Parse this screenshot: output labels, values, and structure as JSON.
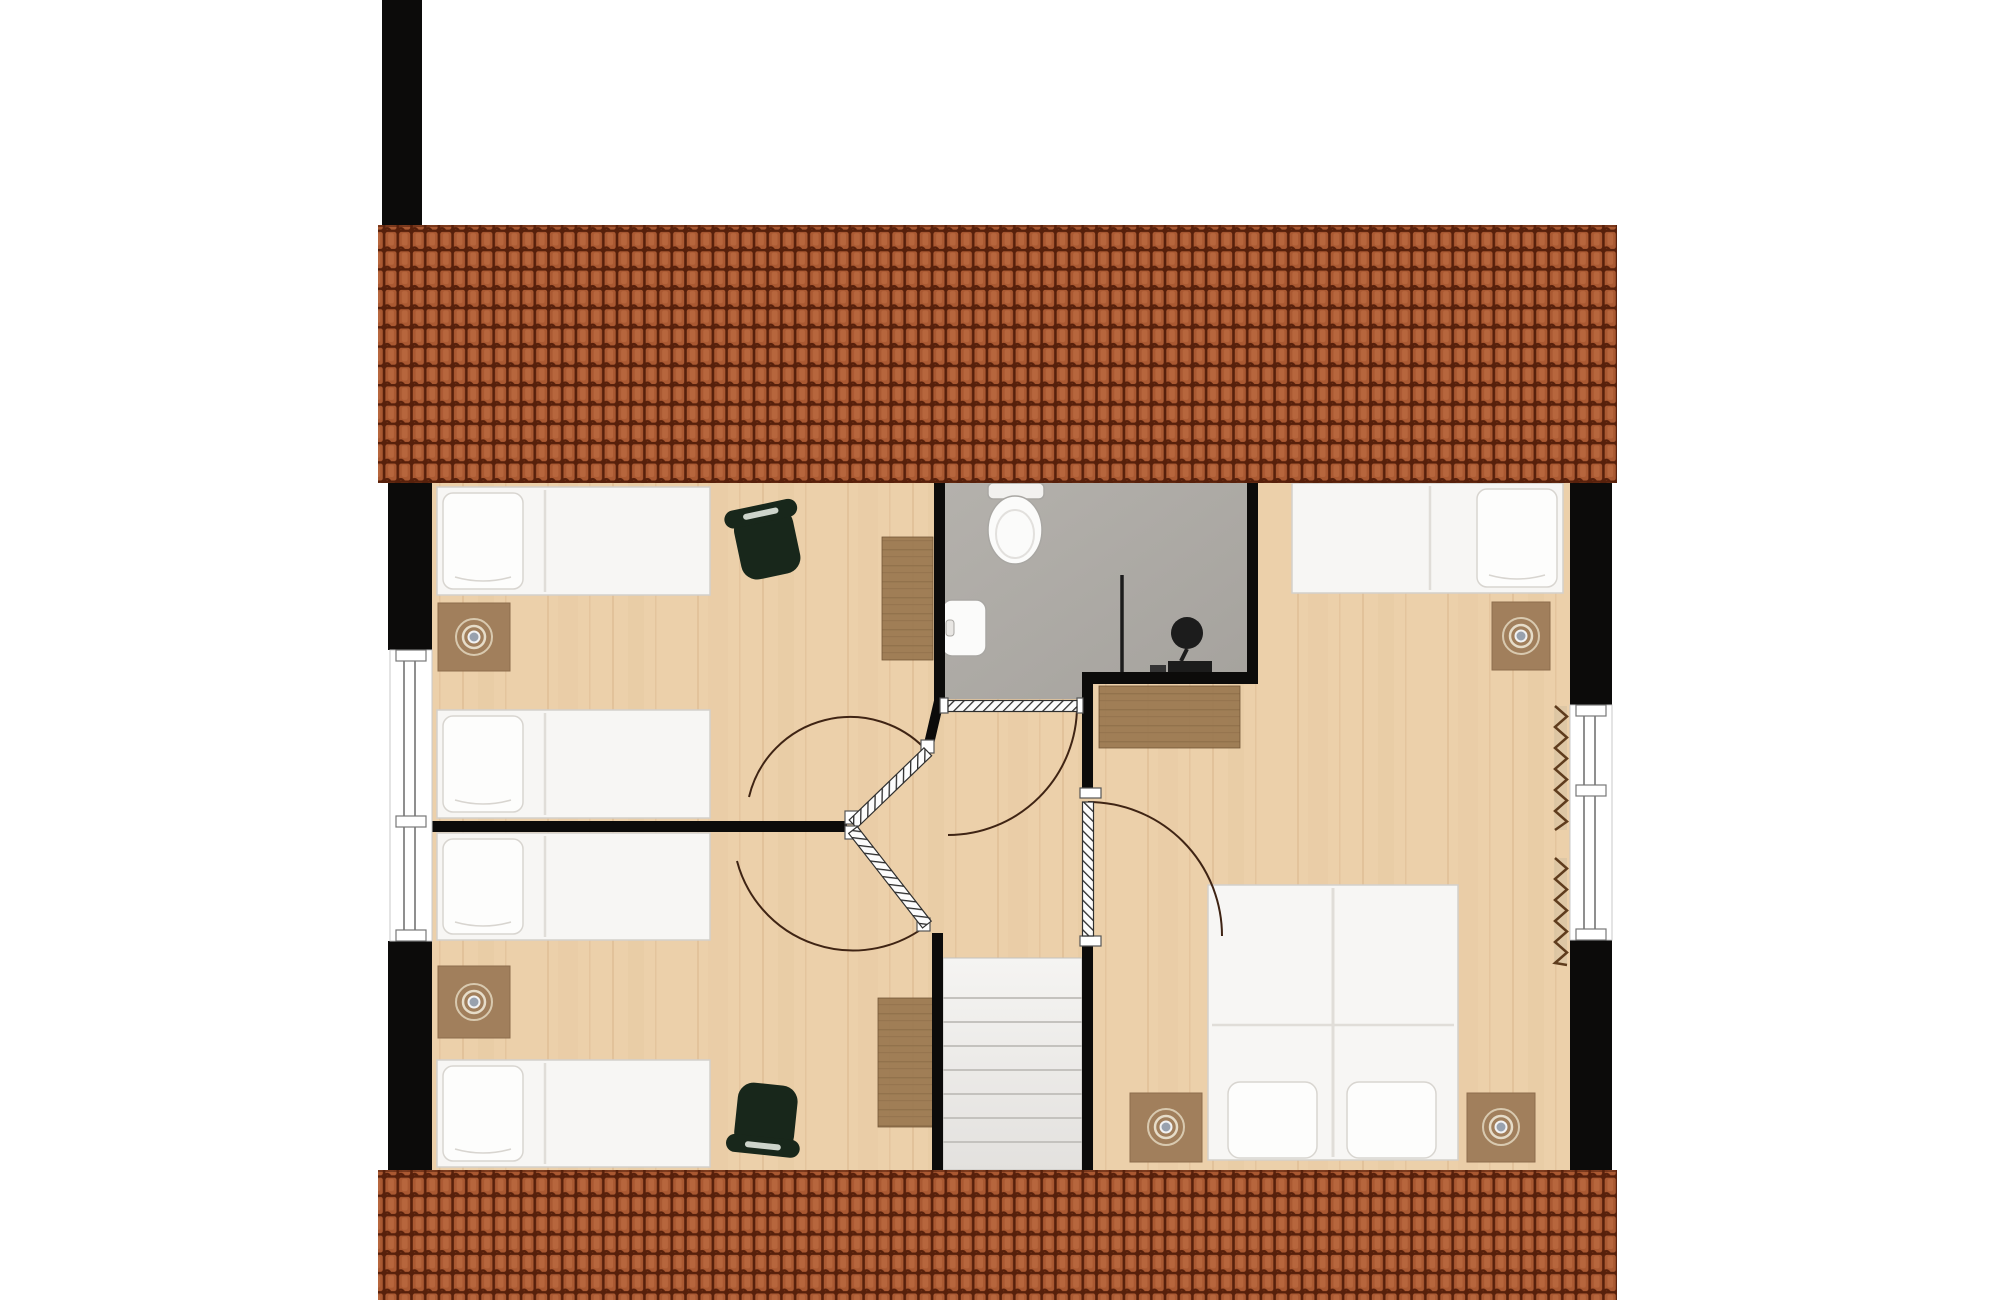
{
  "app": {
    "kind": "architectural-floor-plan",
    "storey": "attic",
    "visible_text": []
  },
  "canvas": {
    "w": 2000,
    "h": 1300,
    "bg": "#ffffff"
  },
  "palette": {
    "wall": "#0c0b0a",
    "roof_tile": "#aa5932",
    "roof_tile_light": "#b7663d",
    "roof_seam": "#57200b",
    "wood_floor": "#ecd0aa",
    "wood_grain": "#c89d6e",
    "bath_floor_1": "#b4b1ac",
    "bath_floor_2": "#a5a29d",
    "furn_white": "#f7f6f4",
    "furn_white_stroke": "#d3d0cb",
    "pillow": "#fdfdfc",
    "pillow_stroke": "#d8d5d0",
    "seam": "#e0ddd8",
    "rug": "#a17f5c",
    "rug_stroke": "#8d6c4c",
    "wood_furniture": "#9d7b53",
    "wood_furniture_grain": "#6f5233",
    "chair_green": "#18271b",
    "chair_slit": "#cdd4cb",
    "stair_top": "#f5f4f2",
    "stair_bottom": "#e3e1de",
    "stair_line": "#c4c2be",
    "door_leaf": "#fcfcfc",
    "door_hatch": "#2b2b2b",
    "door_arc": "#3f2414",
    "window_stroke": "#8f8f8f",
    "radiator_line": "#5f3c1d",
    "radiator_bg": "#d9c4a3",
    "fixture_stroke": "#a9a7a3",
    "fixture_dark": "#1c1c1c",
    "lamp_ring": "#d8c9af",
    "lamp_ring2": "#e6dcc8",
    "lamp_dot": "#98a1ae"
  },
  "roof": {
    "tile_w": 13.7,
    "tile_h": 19.3,
    "bands": [
      {
        "name": "roof-top",
        "x": 378,
        "y": 225,
        "w": 1239,
        "h": 258
      },
      {
        "name": "roof-bottom",
        "x": 378,
        "y": 1170,
        "w": 1239,
        "h": 130
      }
    ]
  },
  "chimney": {
    "name": "chimney",
    "x": 382,
    "y": 0,
    "w": 40,
    "h": 225
  },
  "floors": {
    "wood": {
      "name": "wood-floor",
      "x": 432,
      "y": 483,
      "w": 1138,
      "h": 687
    },
    "bathroom_points": "945,483 1247,483 1247,672 1093,672 1093,699 945,699"
  },
  "rooms": [
    {
      "name": "room-bedroom-left-top",
      "x": 432,
      "y": 483,
      "w": 502,
      "h": 338
    },
    {
      "name": "room-bedroom-left-bottom",
      "x": 432,
      "y": 832,
      "w": 500,
      "h": 338
    },
    {
      "name": "room-bathroom",
      "x": 945,
      "y": 483,
      "w": 302,
      "h": 216
    },
    {
      "name": "room-hallway",
      "x": 847,
      "y": 660,
      "w": 235,
      "h": 298
    },
    {
      "name": "room-bedroom-right",
      "x": 1093,
      "y": 483,
      "w": 477,
      "h": 687
    },
    {
      "name": "room-staircase",
      "x": 943,
      "y": 958,
      "w": 139,
      "h": 212
    }
  ],
  "walls": [
    {
      "name": "wall-left-upper",
      "x": 388,
      "y": 483,
      "w": 44,
      "h": 167
    },
    {
      "name": "wall-left-lower",
      "x": 388,
      "y": 941,
      "w": 44,
      "h": 229
    },
    {
      "name": "wall-divider-left-rooms",
      "x": 432,
      "y": 821,
      "w": 415,
      "h": 11
    },
    {
      "name": "wall-right-upper",
      "x": 1570,
      "y": 483,
      "w": 42,
      "h": 222
    },
    {
      "name": "wall-right-lower",
      "x": 1570,
      "y": 940,
      "w": 42,
      "h": 230
    },
    {
      "name": "wall-bathroom-left",
      "x": 934,
      "y": 483,
      "w": 11,
      "h": 216
    },
    {
      "name": "wall-bathroom-doorstub-left",
      "x": 934,
      "y": 699,
      "w": 14,
      "h": 13
    },
    {
      "name": "wall-bathroom-doorstub-right",
      "x": 1077,
      "y": 699,
      "w": 5,
      "h": 13
    },
    {
      "name": "wall-bathroom-bottom-right",
      "x": 1093,
      "y": 672,
      "w": 165,
      "h": 12
    },
    {
      "name": "wall-bathroom-right",
      "x": 1247,
      "y": 483,
      "w": 11,
      "h": 201
    },
    {
      "name": "wall-bedroom-right-upper",
      "x": 1082,
      "y": 672,
      "w": 11,
      "h": 118
    },
    {
      "name": "wall-bedroom-right-lower",
      "x": 1082,
      "y": 946,
      "w": 11,
      "h": 224
    },
    {
      "name": "wall-staircase-left",
      "x": 932,
      "y": 933,
      "w": 11,
      "h": 237
    }
  ],
  "wall_segments": [
    {
      "name": "wall-diagonal-bathroom-corner",
      "x1": 928,
      "y1": 748,
      "x2": 939,
      "y2": 701,
      "w": 10
    }
  ],
  "windows": [
    {
      "name": "window-left",
      "x": 390,
      "y": 650,
      "w": 42,
      "h": 291,
      "lines": [
        404,
        415
      ],
      "dividers": [
        650,
        816,
        930
      ],
      "div_h": 11
    },
    {
      "name": "window-right",
      "x": 1570,
      "y": 705,
      "w": 42,
      "h": 235,
      "lines": [
        1584,
        1595
      ],
      "dividers": [
        705,
        785,
        929
      ],
      "div_h": 11
    }
  ],
  "doors": [
    {
      "name": "door-bathroom",
      "hx": 948,
      "hy": 706,
      "len": 129,
      "thick": 11,
      "angle": 0,
      "jambs": [
        [
          940,
          698,
          8,
          15
        ],
        [
          1077,
          698,
          6,
          15
        ]
      ],
      "arc": "M 1077,706 A 129 129 0 0 1 948,835"
    },
    {
      "name": "door-bedroom-left-top",
      "hx": 853,
      "hy": 824,
      "len": 104,
      "thick": 11,
      "angle": -44,
      "jambs": [
        [
          845,
          811,
          13,
          13
        ],
        [
          921,
          740,
          13,
          13
        ]
      ],
      "arc": "M 928,752 A 104 104 0 0 0 749,797"
    },
    {
      "name": "door-bedroom-left-bottom",
      "hx": 853,
      "hy": 830,
      "len": 120,
      "thick": 11,
      "angle": 52,
      "jambs": [
        [
          845,
          826,
          13,
          13
        ],
        [
          917,
          918,
          13,
          13
        ]
      ],
      "arc": "M 927,925 A 120 120 0 0 1 737,861"
    },
    {
      "name": "door-bedroom-right",
      "hx": 1088,
      "hy": 936,
      "len": 134,
      "thick": 11,
      "angle": -90,
      "jambs": [
        [
          1080,
          788,
          21,
          10
        ],
        [
          1080,
          936,
          21,
          10
        ]
      ],
      "arc": "M 1088,802 A 134 134 0 0 1 1222,936"
    }
  ],
  "stairs": {
    "name": "staircase",
    "x": 943,
    "y": 958,
    "w": 139,
    "h": 212,
    "tread_lines": [
      998,
      1022,
      1046,
      1070,
      1094,
      1118,
      1142
    ]
  },
  "furniture": {
    "single_beds": [
      {
        "name": "single-bed-1",
        "x": 437,
        "y": 487,
        "w": 273,
        "h": 108,
        "pillow_side": "left",
        "seam_x": 545
      },
      {
        "name": "single-bed-2",
        "x": 437,
        "y": 710,
        "w": 273,
        "h": 108,
        "pillow_side": "left",
        "seam_x": 545
      },
      {
        "name": "single-bed-3",
        "x": 437,
        "y": 833,
        "w": 273,
        "h": 107,
        "pillow_side": "left",
        "seam_x": 545
      },
      {
        "name": "single-bed-4",
        "x": 437,
        "y": 1060,
        "w": 273,
        "h": 107,
        "pillow_side": "left",
        "seam_x": 545
      },
      {
        "name": "single-bed-5",
        "x": 1292,
        "y": 483,
        "w": 271,
        "h": 110,
        "pillow_side": "right",
        "seam_x": 1430
      }
    ],
    "double_bed": {
      "name": "double-bed",
      "x": 1208,
      "y": 885,
      "w": 250,
      "h": 275,
      "seam_x": 1333,
      "seam_y": 1025,
      "pillows": [
        [
          1228,
          1082,
          89,
          76
        ],
        [
          1347,
          1082,
          89,
          76
        ]
      ]
    },
    "rug_tables": [
      {
        "name": "nightstand-rug-1",
        "x": 438,
        "y": 603,
        "w": 72,
        "h": 68,
        "lamp": [
          474,
          637
        ]
      },
      {
        "name": "nightstand-rug-2",
        "x": 438,
        "y": 966,
        "w": 72,
        "h": 72,
        "lamp": [
          474,
          1002
        ]
      },
      {
        "name": "nightstand-rug-3",
        "x": 1492,
        "y": 602,
        "w": 58,
        "h": 68,
        "lamp": [
          1521,
          636
        ]
      },
      {
        "name": "nightstand-rug-4",
        "x": 1130,
        "y": 1093,
        "w": 72,
        "h": 69,
        "lamp": [
          1166,
          1127
        ]
      },
      {
        "name": "nightstand-rug-5",
        "x": 1467,
        "y": 1093,
        "w": 68,
        "h": 69,
        "lamp": [
          1501,
          1127
        ]
      }
    ],
    "desks": [
      {
        "name": "desk-bedroom-left-top",
        "x": 882,
        "y": 537,
        "w": 51,
        "h": 123
      },
      {
        "name": "desk-bedroom-left-bottom",
        "x": 878,
        "y": 998,
        "w": 55,
        "h": 129
      }
    ],
    "dresser": {
      "name": "dresser",
      "x": 1099,
      "y": 686,
      "w": 141,
      "h": 62
    },
    "chairs": [
      {
        "name": "chair-bedroom-left-top",
        "cx": 767,
        "cy": 543,
        "rot": -12,
        "back": "top"
      },
      {
        "name": "chair-bedroom-left-bottom",
        "cx": 766,
        "cy": 1116,
        "rot": 6,
        "back": "bottom"
      }
    ],
    "radiators": [
      {
        "name": "radiator-right-upper",
        "x": 1553,
        "y1": 706,
        "y2": 830
      },
      {
        "name": "radiator-right-lower",
        "x": 1553,
        "y1": 858,
        "y2": 965
      }
    ],
    "bathroom_fixtures": {
      "toilet": {
        "name": "toilet",
        "tank": [
          988,
          483,
          56,
          16
        ],
        "bowl_cx": 1015,
        "bowl_cy": 530,
        "bowl_rx": 27,
        "bowl_ry": 34
      },
      "basin": {
        "name": "washbasin",
        "x": 942,
        "y": 600,
        "w": 44,
        "h": 56
      },
      "shower": {
        "name": "shower-set",
        "pole": [
          1122,
          575,
          1122,
          672
        ],
        "disc": [
          1187,
          633,
          16
        ],
        "base": [
          1168,
          661,
          44,
          12
        ],
        "base2": [
          1150,
          665,
          16,
          8
        ]
      }
    }
  }
}
